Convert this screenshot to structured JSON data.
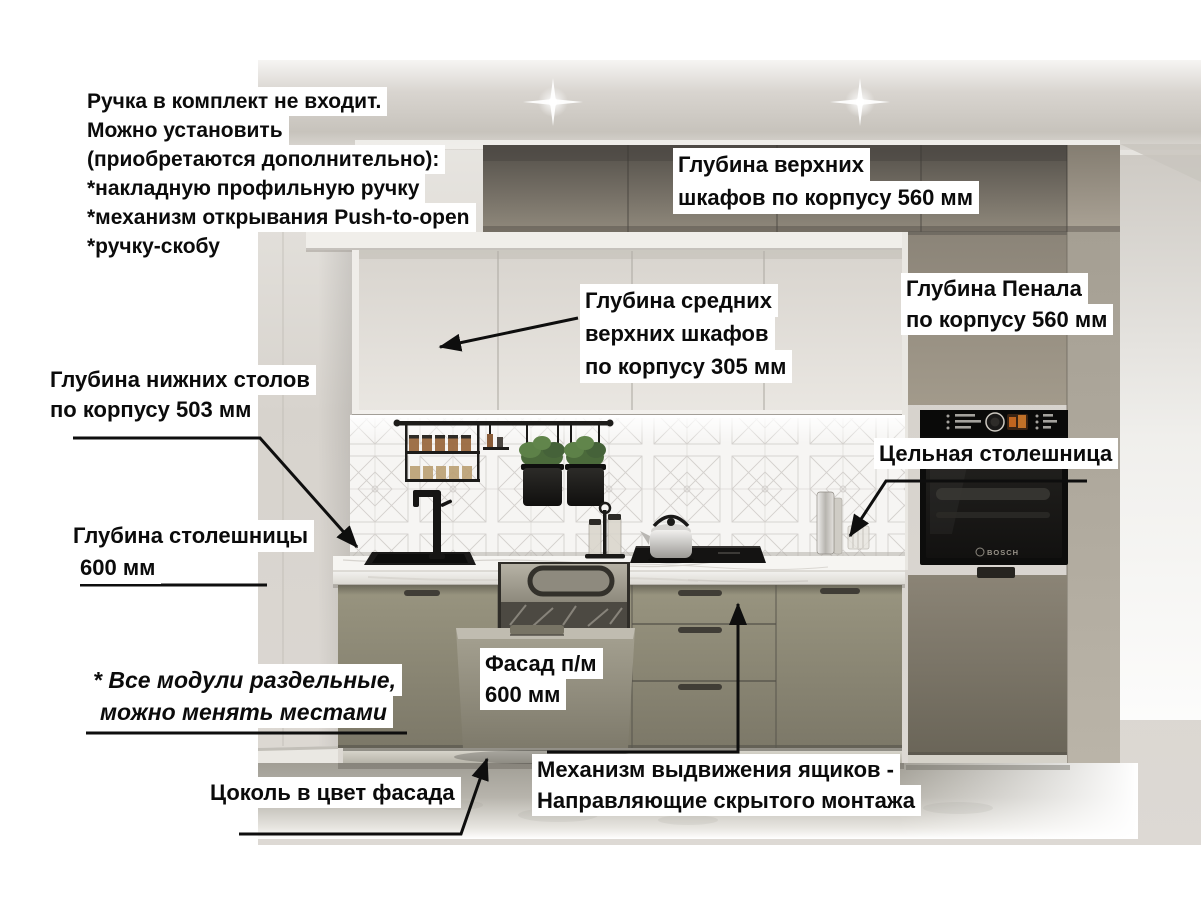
{
  "annotations": {
    "handle_note": {
      "lines": [
        "Ручка в комплект не входит.",
        "Можно установить",
        "(приобретаются дополнительно):",
        "*накладную профильную ручку",
        "*механизм открывания Push-to-open",
        "*ручку-скобу"
      ]
    },
    "upper_cabinet_depth": {
      "lines": [
        "Глубина верхних",
        "шкафов по корпусу 560 мм"
      ]
    },
    "mid_upper_cabinet_depth": {
      "lines": [
        "Глубина средних",
        "верхних шкафов",
        "по корпусу 305 мм"
      ]
    },
    "tall_cabinet_depth": {
      "lines": [
        "Глубина Пенала",
        "по корпусу 560 мм"
      ]
    },
    "base_cabinet_depth": {
      "lines": [
        "Глубина нижних столов",
        "по корпусу 503 мм"
      ]
    },
    "solid_countertop": {
      "text": "Цельная столешница"
    },
    "countertop_depth": {
      "lines": [
        "Глубина столешницы",
        "600 мм"
      ]
    },
    "dishwasher_facade": {
      "lines": [
        "Фасад п/м",
        "600 мм"
      ]
    },
    "modules_note": {
      "lines": [
        "* Все модули раздельные,",
        "можно менять местами"
      ]
    },
    "plinth_note": {
      "text": "Цоколь в цвет фасада"
    },
    "drawer_mechanism_note": {
      "lines": [
        "Механизм выдвижения ящиков -",
        "Направляющие скрытого монтажа"
      ]
    }
  },
  "scene": {
    "oven_brand": "BOSCH"
  },
  "colors": {
    "facade_gray_olive": "#8a8678",
    "upper_dark_taupe": "#6b655d",
    "white_cabinet": "#e6e3de",
    "countertop_white": "#f4f3f0",
    "wall_gray": "#d7d3cd",
    "floor_concrete": "#b1aea6",
    "appliance_black": "#121211",
    "oven_display_orange": "#c1651f",
    "annotation_text": "#0b0b0b",
    "annotation_bg": "#ffffff",
    "arrow_color": "#0e0e0e"
  }
}
